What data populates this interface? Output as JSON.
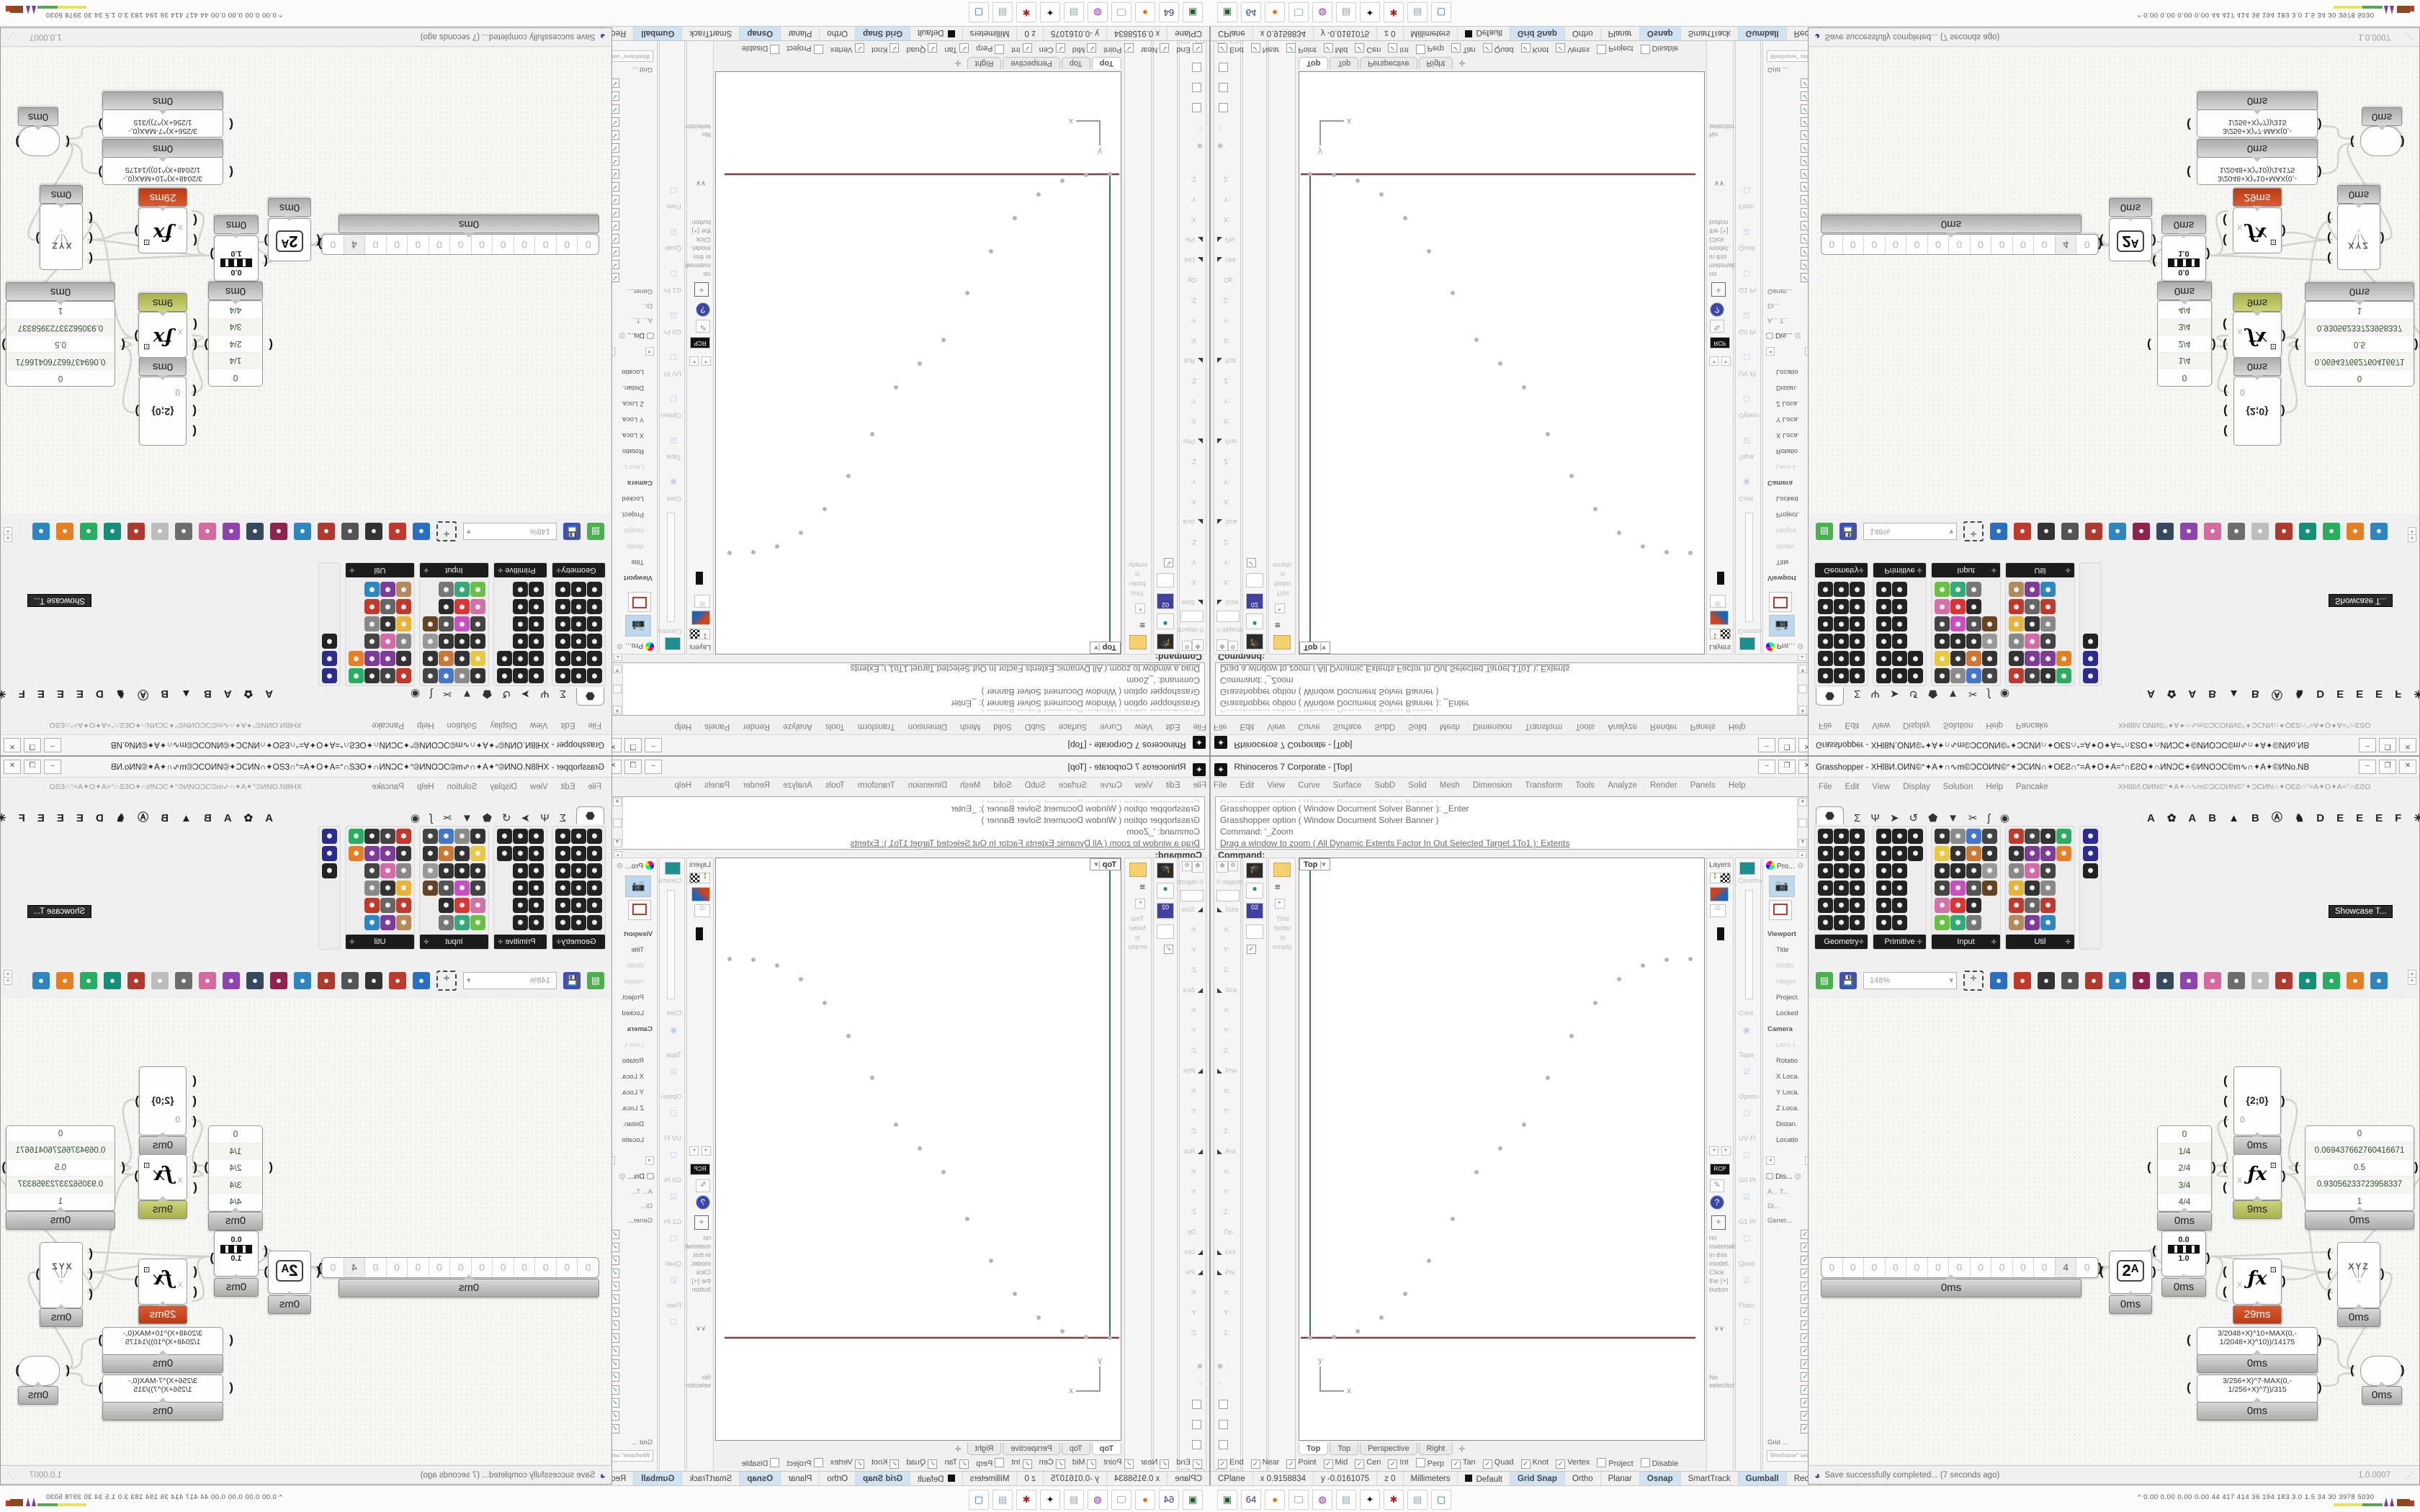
{
  "colors": {
    "selected_time": "#cc4a28",
    "ok_time_olive": "#b3ba60",
    "axis_green": "#3f7a3f",
    "axis_red": "#7d3f3f",
    "point_grey": "#b5b5b5",
    "status_on": "#cfe3f2"
  },
  "rhino": {
    "title": "Rhinoceros 7 Corporate - [Top]",
    "menu": [
      "File",
      "Edit",
      "View",
      "Curve",
      "Surface",
      "SubD",
      "Solid",
      "Mesh",
      "Dimension",
      "Transform",
      "Tools",
      "Analyze",
      "Render",
      "Panels",
      "Help"
    ],
    "command_history": [
      "Grasshopper option ( Window  Document  Solver  Banner ): _Enter",
      "Grasshopper option ( Window  Document  Solver  Banner )",
      "Command: '_Zoom",
      "Drag a window to zoom ( All  Dynamic  Extents  Factor  In  Out  Selected  Target 1To1 ):  Extents"
    ],
    "command_prompt": "Command:",
    "boxedit": {
      "objects": "0 objects",
      "sections": [
        "Size",
        "X:",
        "Y:",
        "Z:",
        "Sca",
        "X:",
        "Y:",
        "Z:",
        "Pos",
        "X:",
        "Y:",
        "Z:",
        "Rot",
        "X:",
        "Y:",
        "Z:",
        "Op",
        "Uni",
        "Piv",
        "X:",
        "Y:",
        "Z:"
      ]
    },
    "file_panel": {
      "empty_text": "This folder is empty."
    },
    "viewport": {
      "label": "Top",
      "tabs": [
        "Top",
        "Top",
        "Perspective",
        "Right"
      ],
      "new_tab": "✛",
      "axis_x": "x",
      "axis_y": "y"
    },
    "layers_title": "Layers",
    "materials": {
      "rcp": "RCP",
      "empty_text": "no materials in this model. Click the [+] button",
      "chevrons": "∨∨",
      "selection": "No selection"
    },
    "constraint": {
      "tab": "Constra",
      "labels": [
        "Cont",
        "Tapa",
        "Option",
        "UV Fl",
        "G0 Pr",
        "G1 Pr",
        "Quali",
        "Flatn"
      ]
    },
    "properties": {
      "tab": "Pro...",
      "items": [
        {
          "t": "Viewport",
          "dim": false
        },
        {
          "t": "Title",
          "dim": false
        },
        {
          "t": "Width",
          "dim": true
        },
        {
          "t": "Height",
          "dim": true
        },
        {
          "t": "Project.",
          "dim": false
        },
        {
          "t": "Locked",
          "dim": false
        },
        {
          "t": "Camera",
          "dim": false
        },
        {
          "t": "Lens L.",
          "dim": true
        },
        {
          "t": "Rotatio",
          "dim": false
        },
        {
          "t": "X Loca.",
          "dim": false
        },
        {
          "t": "Y Loca.",
          "dim": false
        },
        {
          "t": "Z Loca.",
          "dim": false
        },
        {
          "t": "Distan.",
          "dim": false
        },
        {
          "t": "Locatio",
          "dim": false
        }
      ]
    },
    "display": {
      "tab": "Dis...",
      "cols": "A...   T...",
      "mode": "Di...",
      "general": "Gener...",
      "grid": "Grid ...",
      "setting": "Wireframe\" sett",
      "checkbox_count": 16
    },
    "osnap": [
      {
        "l": "End",
        "c": true
      },
      {
        "l": "Near",
        "c": true
      },
      {
        "l": "Point",
        "c": true
      },
      {
        "l": "Mid",
        "c": true
      },
      {
        "l": "Cen",
        "c": true
      },
      {
        "l": "Int",
        "c": true
      },
      {
        "l": "Perp",
        "c": false
      },
      {
        "l": "Tan",
        "c": true
      },
      {
        "l": "Quad",
        "c": true
      },
      {
        "l": "Knot",
        "c": true
      },
      {
        "l": "Vertex",
        "c": true
      },
      {
        "l": "Project",
        "c": false
      },
      {
        "l": "Disable",
        "c": false
      }
    ],
    "status": [
      {
        "t": "CPlane",
        "on": false
      },
      {
        "t": "x 0.9158834",
        "on": false
      },
      {
        "t": "y -0.0161075",
        "on": false
      },
      {
        "t": "z 0",
        "on": false
      },
      {
        "t": "Millimeters",
        "on": false
      },
      {
        "t": "Default",
        "on": false,
        "swatch": true
      },
      {
        "t": "Grid Snap",
        "on": true
      },
      {
        "t": "Ortho",
        "on": false
      },
      {
        "t": "Planar",
        "on": false
      },
      {
        "t": "Osnap",
        "on": true
      },
      {
        "t": "SmartTrack",
        "on": false
      },
      {
        "t": "Gumball",
        "on": true
      },
      {
        "t": "Record History",
        "on": false
      },
      {
        "t": "Filter",
        "on": false
      }
    ]
  },
  "grasshopper": {
    "title": "Grasshopper - XHƖ8И.OИN©°✦A✦∩∿m©ƆCOИN©°✦ƆCИN∩✦OƐƧ∩°=A✦O✦A=°∩ƐƧO✦∩ИNƆC✦©ИNOƆC©m∿∩✦A✦©ИNo.NB",
    "menu": [
      "File",
      "Edit",
      "View",
      "Display",
      "Solution",
      "Help",
      "Pancake"
    ],
    "menu_extra": "XHƖ8И.OИN©°✦A✦∩∿m©ƆCOИN©°✦ƆCИN∩✦OƐƧ∩°=A✦O✦A=°∩ƐƧO",
    "tab_icons": [
      "⬣",
      "Σ",
      "Ψ",
      "➤",
      "↺",
      "⬟",
      "▼",
      "✂",
      "ʃ",
      "◉"
    ],
    "tab_letters": [
      "A",
      "✿",
      "A",
      "B",
      "▲",
      "B",
      "Ⓐ",
      "♞",
      "D",
      "E",
      "E",
      "E",
      "F",
      "✳",
      "✺",
      "❚",
      "G",
      "G"
    ],
    "groups": [
      {
        "name": "Geometry",
        "cols": 4,
        "icons": [
          "#222",
          "#222",
          "#222",
          "#222",
          "#222",
          "#222",
          "#222",
          "#222",
          "#222",
          "#222",
          "#222",
          "#222",
          "#222",
          "#222",
          "#222",
          "#222",
          "#222",
          "#222"
        ]
      },
      {
        "name": "Primitive",
        "cols": 4,
        "icons": [
          "#222",
          "#222",
          "#222",
          "#222",
          "#222",
          "#222",
          "#222",
          "#222",
          "#222",
          "#222",
          "#222",
          "#222",
          "#222",
          "#222"
        ]
      },
      {
        "name": "Input",
        "cols": 5,
        "icons": [
          "#333",
          "#e8c93e",
          "#2e2e2e",
          "#444",
          "#d470a8",
          "#6abf45",
          "#8a8a8a",
          "#333",
          "#2b2b2b",
          "#c94fc0",
          "#d33",
          "#3a7",
          "#47c",
          "#c73",
          "#333",
          "#555",
          "#2b2b2b",
          "#777",
          "#444",
          "#333",
          "#999",
          "#642"
        ]
      },
      {
        "name": "Util",
        "cols": 5,
        "icons": [
          "#c0392b",
          "#333",
          "#888",
          "#e7b43a",
          "#c0392b",
          "#b58a5a",
          "#444",
          "#7d3c98",
          "#d46aa8",
          "#333",
          "#666",
          "#7d3c98",
          "#333",
          "#7d3c98",
          "#444",
          "#888",
          "#c0392b",
          "#2e86c1",
          "#27ae60",
          "#e67e22"
        ]
      },
      {
        "name": "",
        "cols": 1,
        "icons": [
          "#2b2b8f",
          "#2b2b8f",
          "#222"
        ]
      }
    ],
    "tooltip": "Showcase T...",
    "toolbar": {
      "zoom": "148%",
      "icons": [
        "#4caf50",
        "#3f51b5",
        "zoom",
        "zoomwin",
        "#2a6fbf",
        "#c0392b",
        "#333",
        "#555",
        "#b03a2e",
        "#2e86c1",
        "#8e244d",
        "#34495e",
        "#8e44ad",
        "#d46a9e",
        "#6d6d6d",
        "#bdbdbd",
        "#b03a2e",
        "#148f77",
        "#27ae60",
        "#e67e22",
        "#2e86c1"
      ]
    },
    "canvas_nodes": {
      "slider": {
        "digits": [
          "0",
          "0",
          "0",
          "0",
          "0",
          "0",
          "0",
          "0",
          "0",
          "0",
          "0",
          "4",
          "0"
        ],
        "time": "0ms"
      },
      "pow2": {
        "glyph": "2ᴬ",
        "time": "0ms"
      },
      "remap": {
        "top": "0.0",
        "bottom": "1.0",
        "time": "0ms"
      },
      "relay": {
        "label": "{2;0}",
        "input3": "0",
        "time": "0ms"
      },
      "quarters": {
        "rows": [
          "0",
          "1/4",
          "2/4",
          "3/4",
          "4/4"
        ],
        "time": "0ms"
      },
      "fx_a": {
        "glyph": "ƒx",
        "sup": "⊡",
        "input": "X",
        "time": "9ms"
      },
      "values": {
        "rows": [
          "0",
          "0.069437662760416671",
          "0.5",
          "0.93056233723958337",
          "1"
        ],
        "time": "0ms"
      },
      "fx_b": {
        "glyph": "ƒx",
        "sup": "⊡",
        "input": "X",
        "time": "29ms"
      },
      "xyz": {
        "glyph": "XYZ",
        "time": "0ms"
      },
      "expr1": {
        "text_l1": "3/2048+X)^10+MAX(0,-",
        "text_l2": "1/2048+X)^10))/14175",
        "time": "0ms"
      },
      "expr2": {
        "text_l1": "3/256+X)^7-MAX(0,-",
        "text_l2": "1/256+X)^7))/315",
        "time": "0ms"
      },
      "capsule": {
        "time": "0ms"
      }
    },
    "statusbar": {
      "icon": "◕",
      "text": "Save successfully completed... (7 seconds ago)",
      "version": "1.0.0007"
    }
  },
  "taskbar": {
    "icons": [
      {
        "n": "device-icon",
        "g": "▣",
        "c": "#1b5e20"
      },
      {
        "n": "dosbox-icon",
        "g": "64",
        "c": "#283593"
      },
      {
        "n": "firefox-icon",
        "g": "●",
        "c": "#e8710a"
      },
      {
        "n": "remote-desktop-icon",
        "g": "🖵",
        "c": "#607d8b"
      },
      {
        "n": "app-purple-icon",
        "g": "◍",
        "c": "#8e24aa"
      },
      {
        "n": "notepad-icon",
        "g": "▤",
        "c": "#90a4ae"
      },
      {
        "n": "rhino-icon",
        "g": "✦",
        "c": "#111111"
      },
      {
        "n": "settings-red-icon",
        "g": "✱",
        "c": "#b71c1c"
      },
      {
        "n": "notepad2-icon",
        "g": "▤",
        "c": "#90a4ae"
      },
      {
        "n": "explorer-icon",
        "g": "▢",
        "c": "#1565c0"
      }
    ],
    "tray_chevron": "^",
    "tray_values": [
      "0.00 0.00 0.00 0.00",
      "44",
      "417",
      "414",
      "36",
      "194",
      "183",
      "3.0",
      "1.5",
      "34",
      "30",
      "3978",
      "5030"
    ]
  },
  "viewport_points": [
    [
      137,
      806
    ],
    [
      170,
      805
    ],
    [
      203,
      797
    ],
    [
      236,
      778
    ],
    [
      269,
      745
    ],
    [
      302,
      699
    ],
    [
      335,
      641
    ],
    [
      368,
      576
    ],
    [
      401,
      543
    ],
    [
      434,
      510
    ],
    [
      467,
      445
    ],
    [
      500,
      387
    ],
    [
      533,
      341
    ],
    [
      566,
      308
    ],
    [
      599,
      289
    ],
    [
      632,
      281
    ],
    [
      665,
      280
    ]
  ]
}
